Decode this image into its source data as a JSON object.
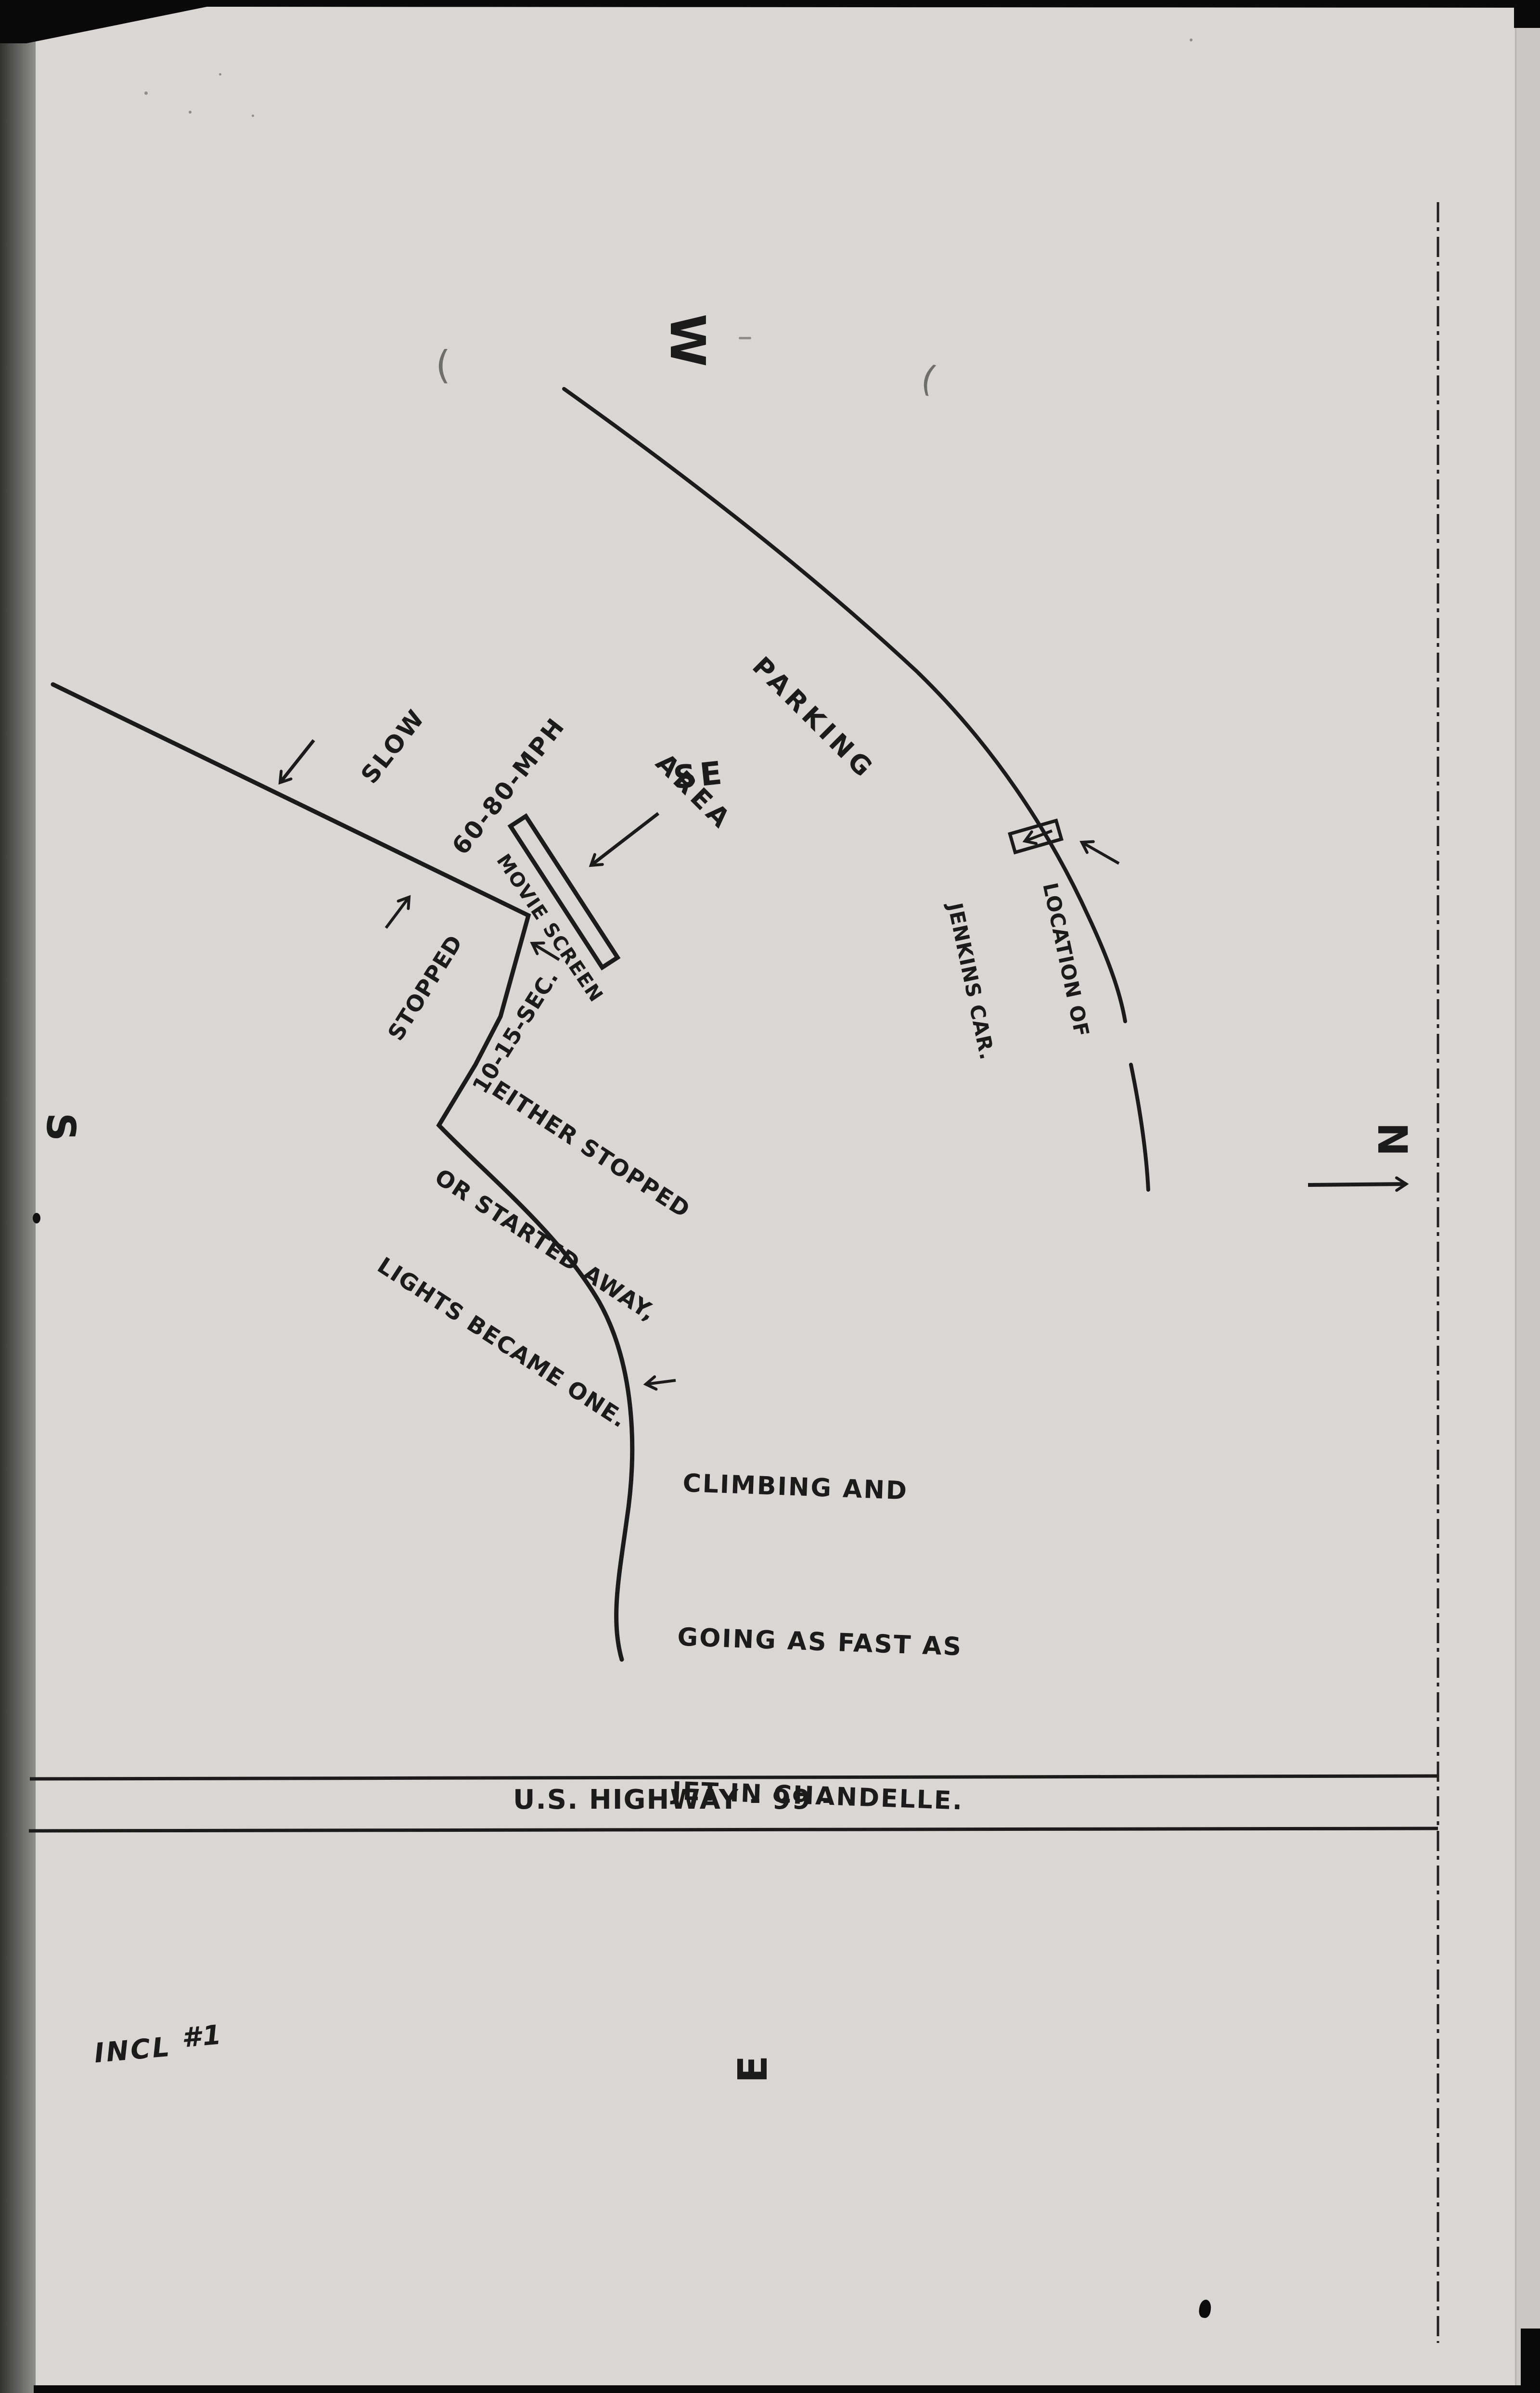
{
  "document": {
    "type": "hand-drawn incident sketch (photocopy)",
    "paper_color": "#d8d7d3",
    "ink_color": "#1b1b1b",
    "enclosure_note": {
      "word": "INCL",
      "number": "#1"
    }
  },
  "compass": {
    "west": "W",
    "north": "N",
    "south": "S",
    "east": "E"
  },
  "labels": {
    "parking": {
      "lines": [
        "PARKING",
        "AREA"
      ]
    },
    "slow": {
      "lines": [
        "SLOW",
        "60-80-MPH"
      ]
    },
    "se_heading": "SE",
    "movie_screen": "MOVIE SCREEN",
    "stopped": {
      "lines": [
        "STOPPED",
        "10-15-SEC."
      ]
    },
    "either": {
      "lines": [
        "EITHER STOPPED",
        "OR STARTED AWAY,",
        "LIGHTS BECAME ONE."
      ]
    },
    "jenkins": {
      "lines": [
        "LOCATION OF",
        "JENKINS CAR."
      ]
    },
    "climbing": {
      "lines": [
        "CLIMBING AND",
        "GOING AS FAST AS",
        "JET IN CHANDELLE."
      ]
    },
    "highway": "U.S. HIGHWAY - 99 -"
  },
  "stray_marks": {
    "paren1": "(",
    "paren2": "("
  }
}
